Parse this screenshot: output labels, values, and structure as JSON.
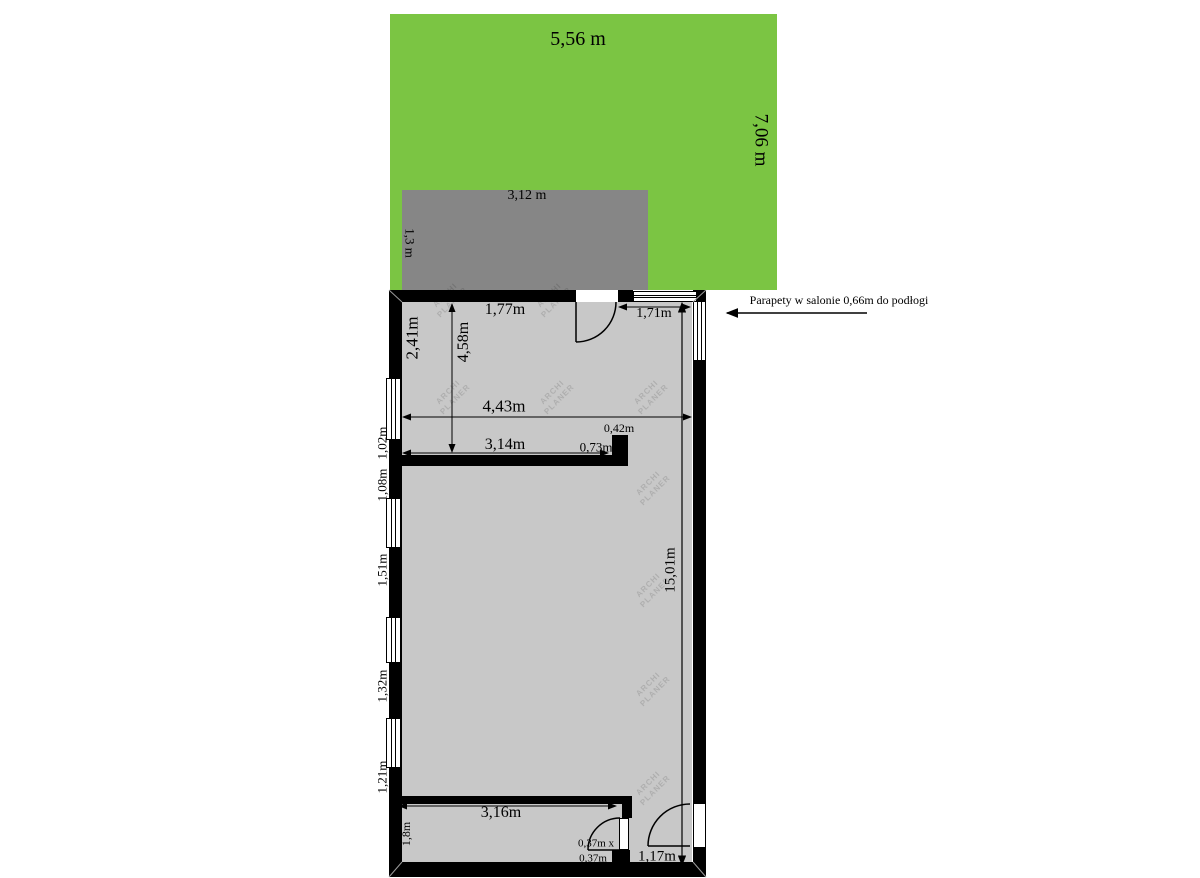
{
  "colors": {
    "garden_green": "#7bc543",
    "balcony_gray": "#868686",
    "floor_gray": "#c8c8c8",
    "wall_black": "#000000",
    "window_white": "#ffffff"
  },
  "garden": {
    "width_label": "5,56 m",
    "height_label": "7,06 m"
  },
  "balcony": {
    "width_label": "3,12 m",
    "depth_label": "1,3 m"
  },
  "floor_plan": {
    "salon": {
      "left_wall_top": "2,41m",
      "room_height": "4,58m",
      "top_door_width": "1,77m",
      "top_window_width": "1,71m",
      "room_width": "4,43m",
      "partition_wall": "3,14m",
      "block_width": "0,42m",
      "block_depth": "0,73m"
    },
    "left_wall_segments": [
      "1,02m",
      "1,08m",
      "1,51m",
      "1,32m",
      "1,21m"
    ],
    "total_length": "15,01m",
    "bottom_room": {
      "width": "3,16m",
      "depth": "1,8m",
      "pillar_line1": "0,37m x",
      "pillar_line2": "0,37m",
      "entry_door_width": "1,17m"
    }
  },
  "annotation": {
    "text": "Parapety w salonie 0,66m do podłogi"
  },
  "watermark": {
    "line1": "ARCHI",
    "line2": "PLANER"
  }
}
